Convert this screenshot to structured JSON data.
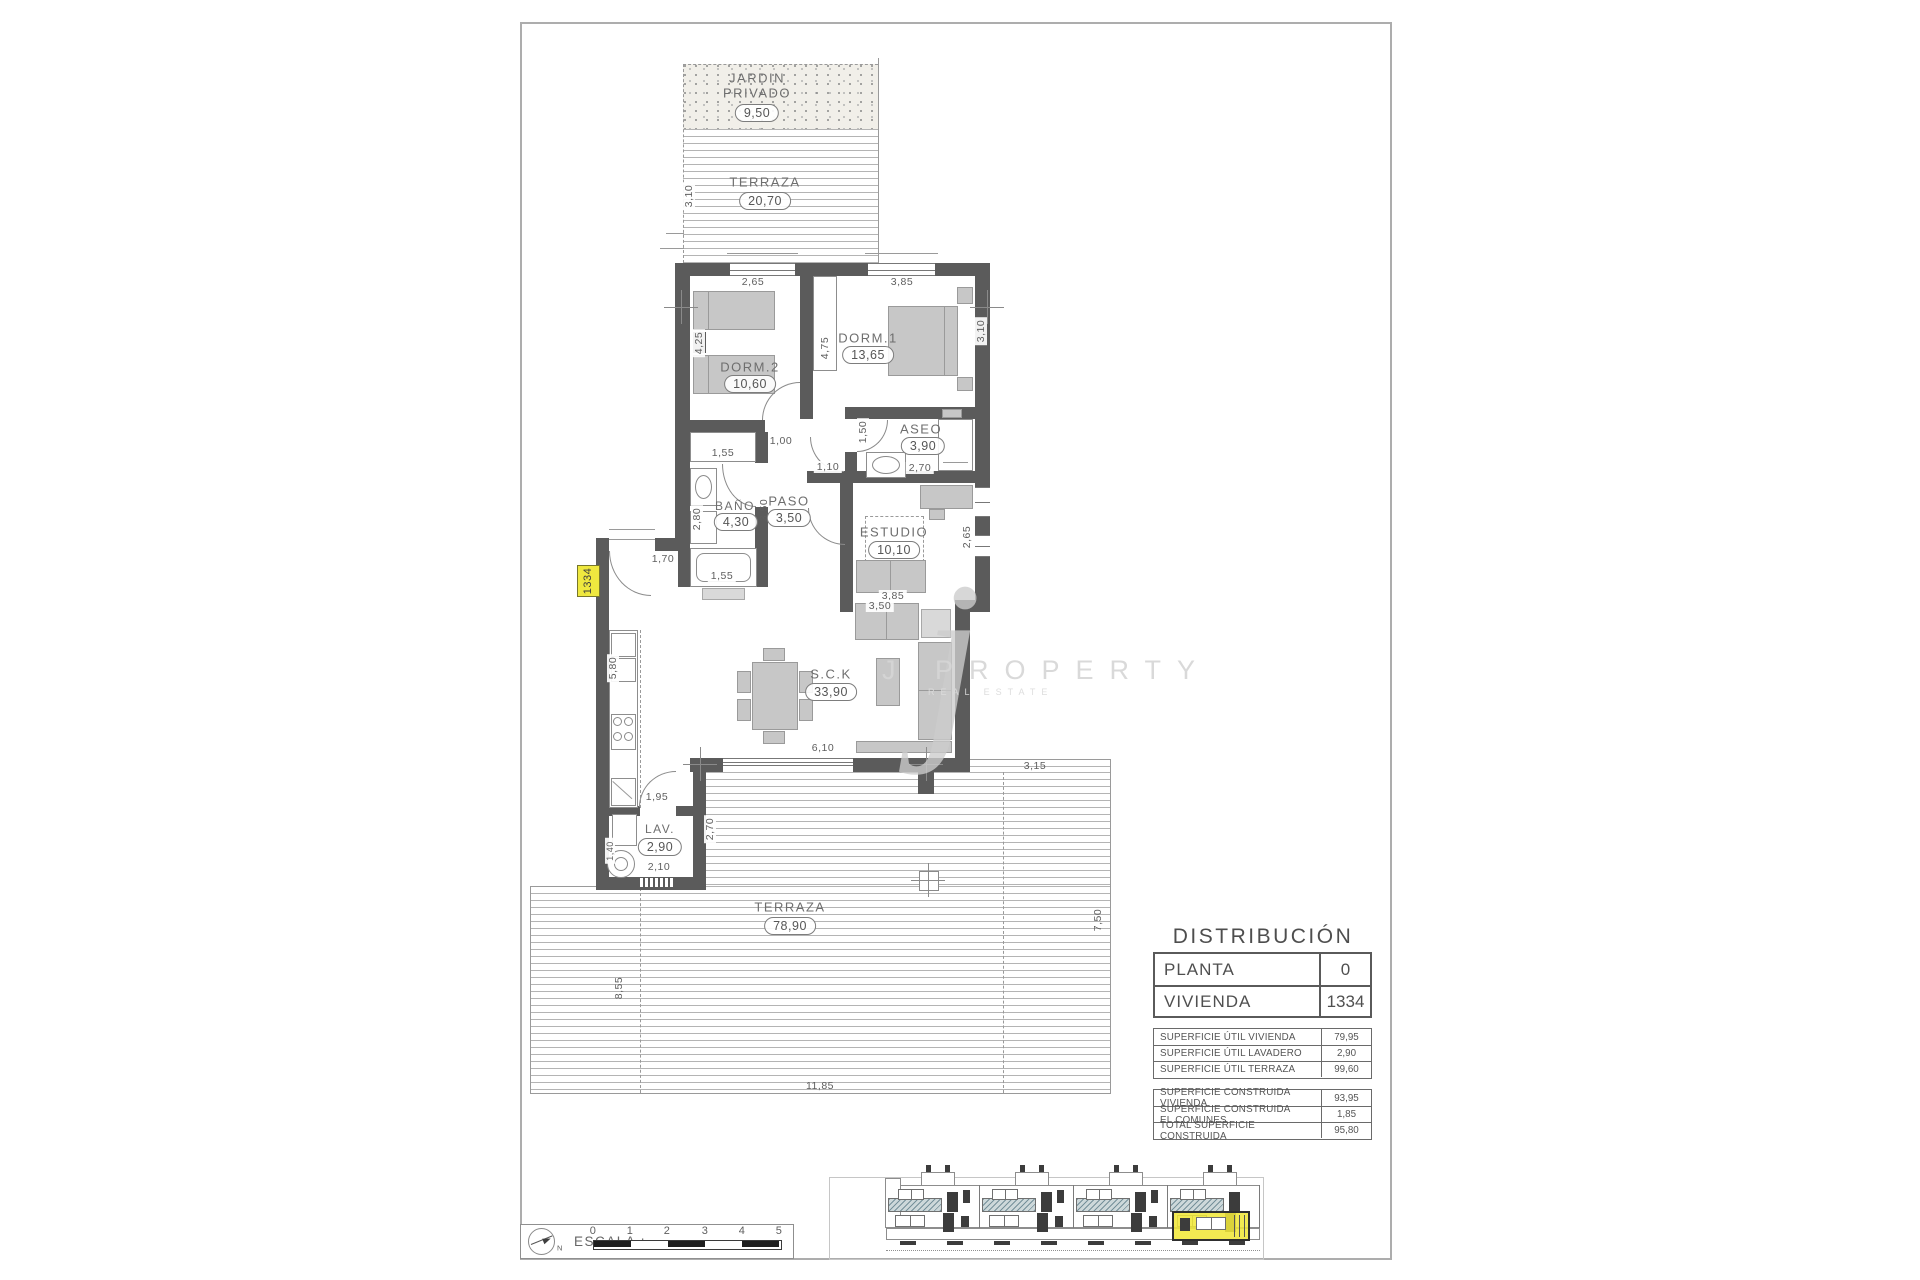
{
  "colors": {
    "wall_gray": "#5b5b5b",
    "furniture_gray": "#c7c7c7",
    "highlight_yellow": "#efe83f",
    "balcony_hatch": "#75909a"
  },
  "plan": {
    "garden": {
      "line1": "JARDIN",
      "line2": "PRIVADO",
      "area": "9,50"
    },
    "terrace_top": {
      "name": "TERRAZA",
      "area": "20,70"
    },
    "rooms": {
      "dorm2": {
        "name": "DORM.2",
        "area": "10,60"
      },
      "dorm1": {
        "name": "DORM.1",
        "area": "13,65"
      },
      "bano": {
        "name": "BAÑO",
        "area": "4,30"
      },
      "paso": {
        "name": "PASO",
        "area": "3,50"
      },
      "aseo": {
        "name": "ASEO",
        "area": "3,90"
      },
      "estudio": {
        "name": "ESTUDIO",
        "area": "10,10"
      },
      "sck": {
        "name": "S.C.K",
        "area": "33,90"
      },
      "lav": {
        "name": "LAV.",
        "area": "2,90"
      },
      "terrace_main": {
        "name": "TERRAZA",
        "area": "78,90"
      }
    },
    "unit_tag": "1334",
    "dims": {
      "win_dorm2": "2,65",
      "win_dorm1": "3,85",
      "dorm2_depth": "4,25",
      "dorm1_depth": "4,75",
      "dorm1_width": "3,10",
      "closet": "1,55",
      "door_dorm1": "1,00",
      "paso_width": "1,10",
      "aseo_door": "1,50",
      "aseo_width": "2,70",
      "bano_width": "2,80",
      "paso_len": "3,50",
      "bathtub": "1,55",
      "estudio_width": "2,65",
      "estudio_sofa": "3,85",
      "sck_sofa": "3,50",
      "entrance": "1,70",
      "kitchen_len": "5,80",
      "sck_width": "6,10",
      "lav_door": "1,95",
      "lav_depth": "2,70",
      "washer": "1,40",
      "lav_width": "2,10",
      "garden_depth": "3,10",
      "terrace_side": "3,15",
      "terrace_right": "7,50",
      "terrace_left": "8,55",
      "terrace_width": "11,85"
    }
  },
  "distribution": {
    "title": "DISTRIBUCIÓN",
    "planta_label": "PLANTA",
    "planta_value": "0",
    "vivienda_label": "VIVIENDA",
    "vivienda_value": "1334",
    "util_rows": [
      {
        "label": "SUPERFICIE ÚTIL VIVIENDA",
        "value": "79,95"
      },
      {
        "label": "SUPERFICIE ÚTIL LAVADERO",
        "value": "2,90"
      },
      {
        "label": "SUPERFICIE ÚTIL TERRAZA",
        "value": "99,60"
      }
    ],
    "built_rows": [
      {
        "label": "SUPERFICIE CONSTRUIDA VIVIENDA",
        "value": "93,95"
      },
      {
        "label": "SUPERFICIE CONSTRUIDA EL.COMUNES",
        "value": "1,85"
      },
      {
        "label": "TOTAL SUPERFICIE CONSTRUIDA",
        "value": "95,80"
      }
    ]
  },
  "footer": {
    "escala_label": "ESCALA :",
    "north": "N",
    "ticks": [
      "0",
      "1",
      "2",
      "3",
      "4",
      "5"
    ]
  },
  "watermark": {
    "initial": "j",
    "brand": "J PROPERTY",
    "tagline": "REAL ESTATE"
  }
}
